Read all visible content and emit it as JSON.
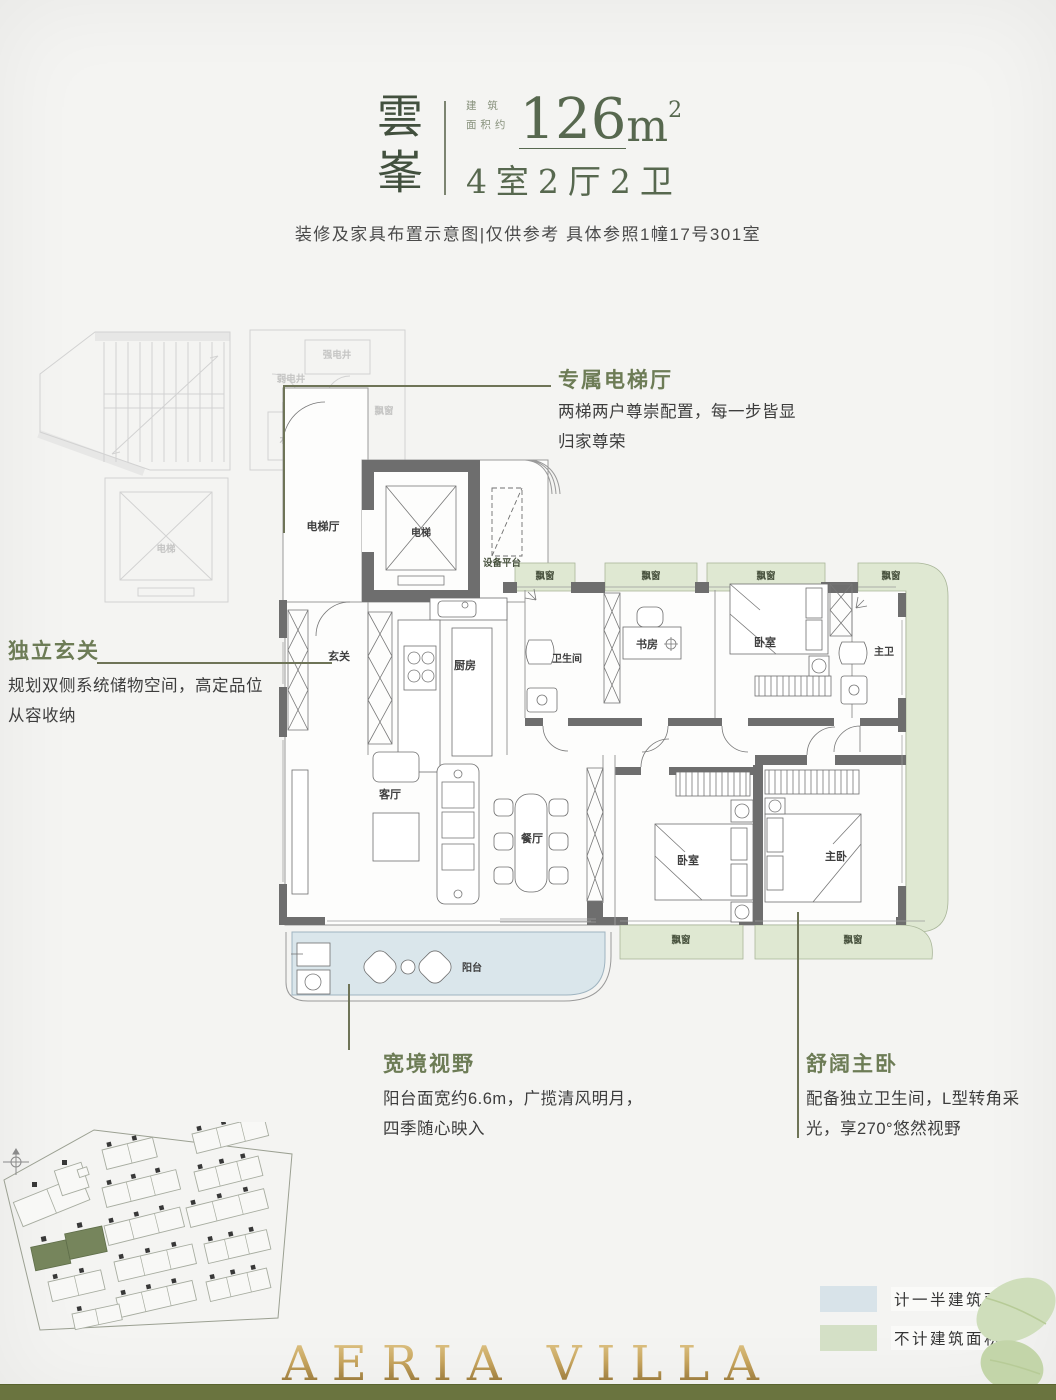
{
  "header": {
    "brand": "雲峯",
    "area_label_line1": "建 筑",
    "area_label_line2": "面积约",
    "area_number": "126",
    "area_unit": "m",
    "area_sup": "2",
    "layout": "4室2厅2卫",
    "disclaimer": "装修及家具布置示意图|仅供参考 具体参照1幢17号301室"
  },
  "callouts": {
    "elevator_hall": {
      "title": "专属电梯厅",
      "body": "两梯两户尊崇配置，每一步皆显归家尊荣"
    },
    "foyer": {
      "title": "独立玄关",
      "body": "规划双侧系统储物空间，高定品位从容收纳"
    },
    "view": {
      "title": "宽境视野",
      "body": "阳台面宽约6.6m，广揽清风明月，四季随心映入"
    },
    "master": {
      "title": "舒阔主卧",
      "body": "配备独立卫生间，L型转角采光，享270°悠然视野"
    }
  },
  "floorplan": {
    "rooms": {
      "elevator_hall": "电梯厅",
      "elevator": "电梯",
      "equipment_platform": "设备平台",
      "foyer": "玄关",
      "kitchen": "厨房",
      "bathroom": "卫生间",
      "study": "书房",
      "bedroom": "卧室",
      "master_bath": "主卫",
      "living": "客厅",
      "dining": "餐厅",
      "balcony": "阳台",
      "master_bedroom": "主卧",
      "bay_window": "飘窗"
    },
    "shafts": {
      "strong_electric": "强电井",
      "weak_electric": "弱电井",
      "water": "水井"
    }
  },
  "legend": {
    "half_area": "计一半建筑面积",
    "excluded_area": "不计建筑面积"
  },
  "footer": {
    "logo": "AERIA VILLA"
  },
  "colors": {
    "accent_green": "#6d7c56",
    "bay_green": "#dfe8d2",
    "balcony_blue": "#dae6eb",
    "wall_gray": "#6e6e6e",
    "band_green": "#6a743f",
    "gold": "#c7a55e",
    "site_highlight": "#76855c",
    "legend_blue": "#d8e3e9",
    "legend_green": "#d4e0c6"
  }
}
